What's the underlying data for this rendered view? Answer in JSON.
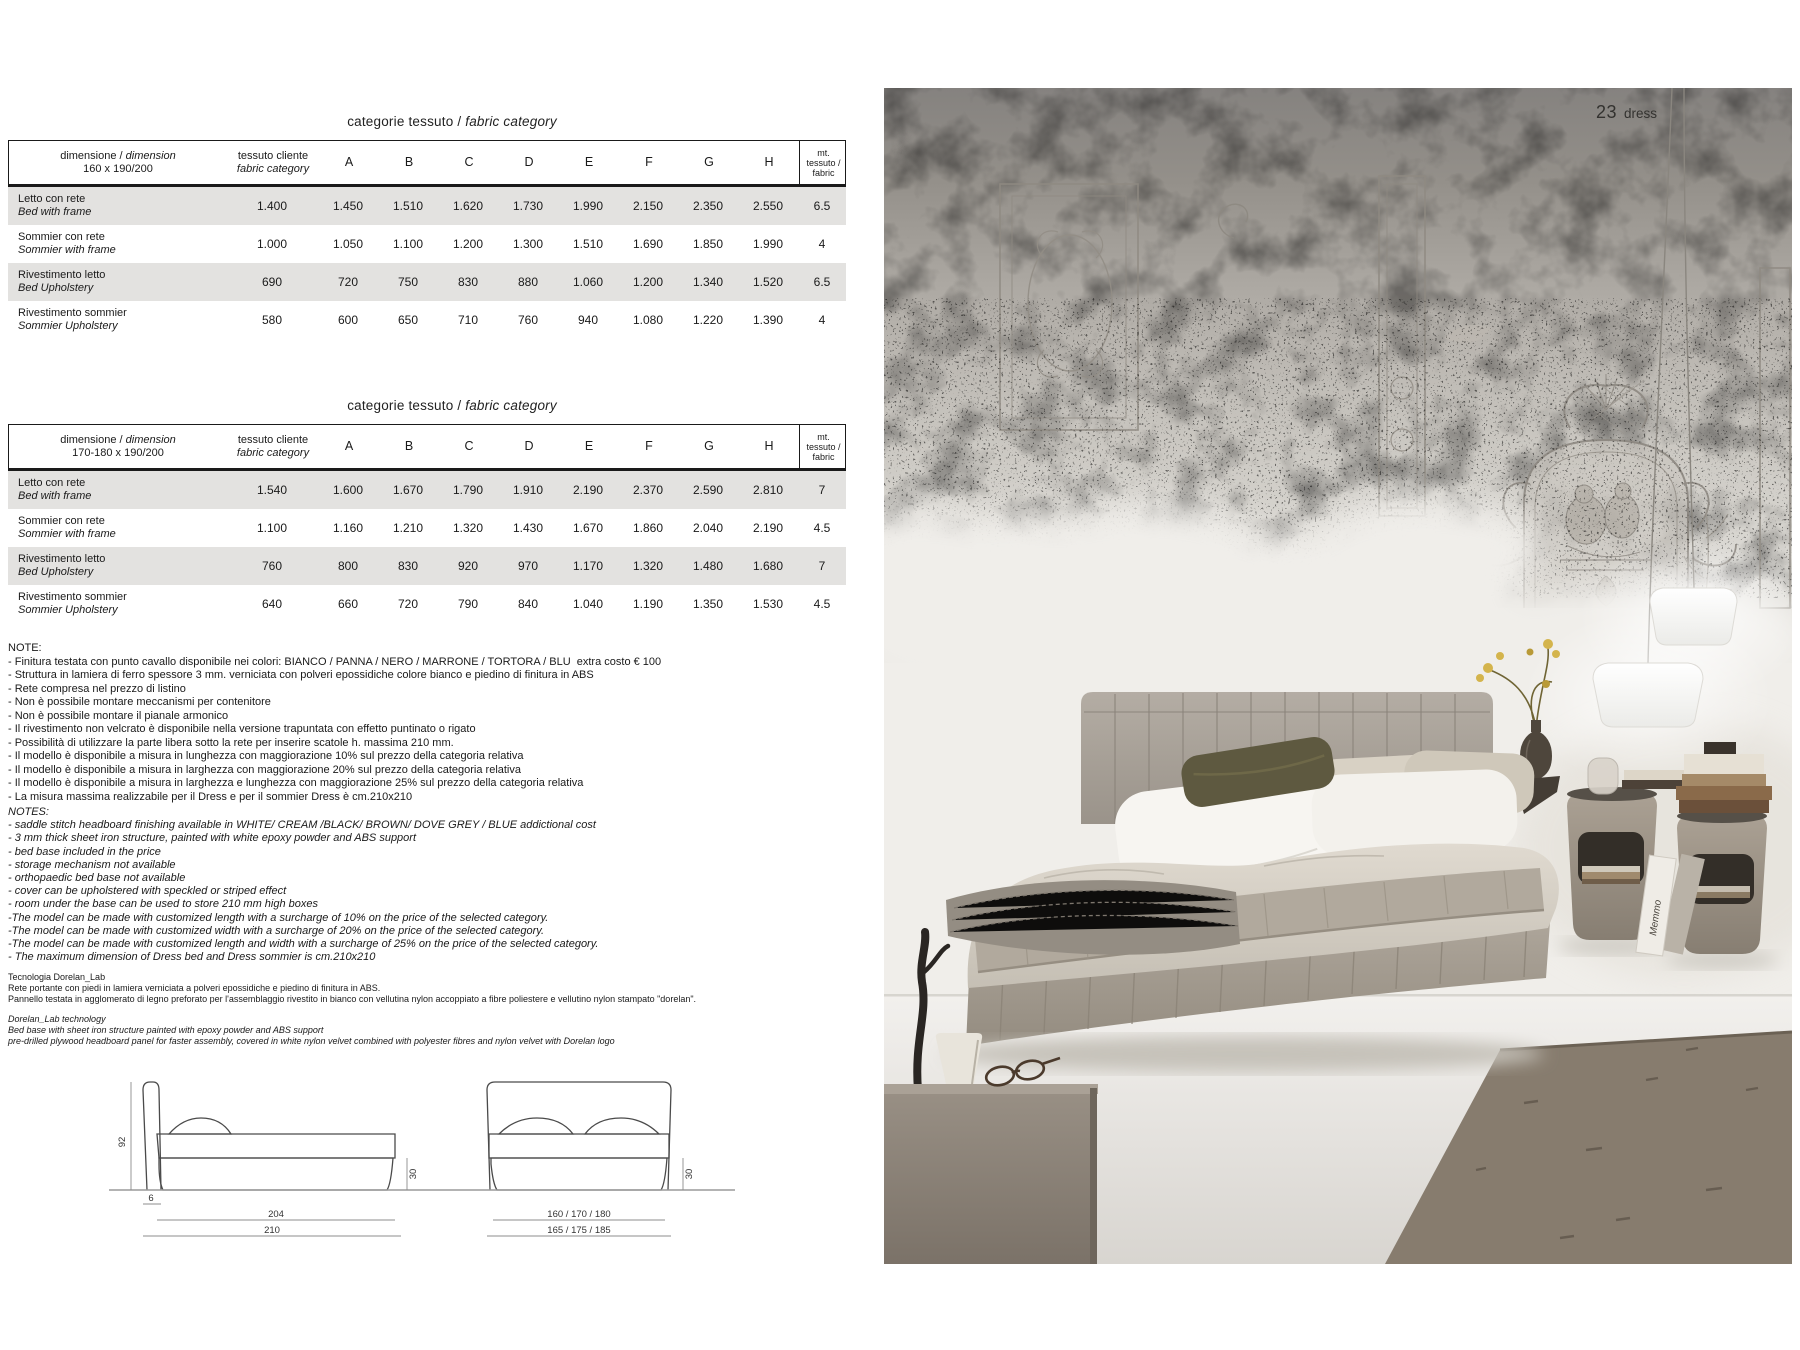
{
  "page_label": {
    "number": "23",
    "name": "dress"
  },
  "table_common": {
    "title_it": "categorie tessuto /",
    "title_en": "fabric category",
    "dimension_prefix_it": "dimensione /",
    "dimension_prefix_en": "dimension",
    "customer_it": "tessuto cliente",
    "customer_en": "fabric category",
    "categories": [
      "A",
      "B",
      "C",
      "D",
      "E",
      "F",
      "G",
      "H"
    ],
    "mt_lines": [
      "mt.",
      "tessuto /",
      "fabric"
    ]
  },
  "tables": [
    {
      "dimension": "160 x 190/200",
      "rows": [
        {
          "it": "Letto con rete",
          "en": "Bed with frame",
          "customer": "1.400",
          "values": [
            "1.450",
            "1.510",
            "1.620",
            "1.730",
            "1.990",
            "2.150",
            "2.350",
            "2.550"
          ],
          "mt": "6.5"
        },
        {
          "it": "Sommier con rete",
          "en": "Sommier with frame",
          "customer": "1.000",
          "values": [
            "1.050",
            "1.100",
            "1.200",
            "1.300",
            "1.510",
            "1.690",
            "1.850",
            "1.990"
          ],
          "mt": "4"
        },
        {
          "it": "Rivestimento letto",
          "en": "Bed Upholstery",
          "customer": "690",
          "values": [
            "720",
            "750",
            "830",
            "880",
            "1.060",
            "1.200",
            "1.340",
            "1.520"
          ],
          "mt": "6.5"
        },
        {
          "it": "Rivestimento sommier",
          "en": "Sommier Upholstery",
          "customer": "580",
          "values": [
            "600",
            "650",
            "710",
            "760",
            "940",
            "1.080",
            "1.220",
            "1.390"
          ],
          "mt": "4"
        }
      ]
    },
    {
      "dimension": "170-180 x 190/200",
      "rows": [
        {
          "it": "Letto con rete",
          "en": "Bed with frame",
          "customer": "1.540",
          "values": [
            "1.600",
            "1.670",
            "1.790",
            "1.910",
            "2.190",
            "2.370",
            "2.590",
            "2.810"
          ],
          "mt": "7"
        },
        {
          "it": "Sommier con rete",
          "en": "Sommier with frame",
          "customer": "1.100",
          "values": [
            "1.160",
            "1.210",
            "1.320",
            "1.430",
            "1.670",
            "1.860",
            "2.040",
            "2.190"
          ],
          "mt": "4.5"
        },
        {
          "it": "Rivestimento letto",
          "en": "Bed Upholstery",
          "customer": "760",
          "values": [
            "800",
            "830",
            "920",
            "970",
            "1.170",
            "1.320",
            "1.480",
            "1.680"
          ],
          "mt": "7"
        },
        {
          "it": "Rivestimento sommier",
          "en": "Sommier Upholstery",
          "customer": "640",
          "values": [
            "660",
            "720",
            "790",
            "840",
            "1.040",
            "1.190",
            "1.350",
            "1.530"
          ],
          "mt": "4.5"
        }
      ]
    }
  ],
  "notes_it": {
    "heading": "NOTE:",
    "items": [
      "- Finitura testata con punto cavallo disponibile nei colori: BIANCO / PANNA / NERO / MARRONE / TORTORA / BLU  extra costo € 100",
      "- Struttura in lamiera di ferro spessore 3 mm. verniciata con polveri epossidiche colore bianco e piedino di finitura in ABS",
      "- Rete compresa nel prezzo di listino",
      "- Non è possibile montare meccanismi per contenitore",
      "- Non è possibile montare il pianale armonico",
      "- Il rivestimento non velcrato è disponibile nella versione trapuntata con effetto puntinato o rigato",
      "- Possibilità di utilizzare la parte libera sotto la rete per inserire scatole h. massima 210 mm.",
      "- Il modello è disponibile a misura in lunghezza con maggiorazione 10% sul prezzo della categoria relativa",
      "- Il modello è disponibile a misura in larghezza con maggiorazione 20% sul prezzo della categoria relativa",
      "- Il modello è disponibile a misura in larghezza e lunghezza con maggiorazione 25% sul prezzo della categoria relativa",
      "- La misura massima realizzabile per il Dress e per il sommier Dress è cm.210x210"
    ]
  },
  "notes_en": {
    "heading": "NOTES:",
    "items": [
      "- saddle stitch headboard finishing available in WHITE/ CREAM /BLACK/ BROWN/ DOVE GREY / BLUE addictional cost",
      "- 3 mm thick sheet iron structure, painted with white epoxy powder and ABS support",
      "- bed base included in the price",
      "- storage mechanism not available",
      "- orthopaedic bed base not available",
      "- cover can be upholstered with speckled or striped effect",
      "- room under the base can be used to store 210 mm high boxes",
      "-The model can be made with customized length with a surcharge of 10% on the price of the selected category.",
      "-The model can be made with customized width with a surcharge of 20% on the price of the selected category.",
      "-The model can be made with customized length and width with a surcharge of 25% on the price of the selected category.",
      "- The maximum dimension of Dress bed and Dress sommier is cm.210x210"
    ]
  },
  "tech_it": {
    "heading": "Tecnologia Dorelan_Lab",
    "lines": [
      "Rete portante con piedi in lamiera verniciata a polveri epossidiche e piedino di finitura in ABS.",
      "Pannello testata in agglomerato di legno preforato per l'assemblaggio rivestito in bianco con vellutina nylon accoppiato a fibre poliestere e vellutino nylon stampato \"dorelan\"."
    ]
  },
  "tech_en": {
    "heading": "Dorelan_Lab technology",
    "lines": [
      "Bed base with sheet iron structure painted with epoxy powder and ABS support",
      "pre-drilled plywood headboard panel for faster assembly, covered in white nylon velvet combined with polyester fibres and nylon velvet with Dorelan logo"
    ]
  },
  "drawings": {
    "side": {
      "height": "92",
      "foot": "6",
      "length_inner": "204",
      "length_outer": "210",
      "base_height": "30"
    },
    "front": {
      "width_inner": "160 / 170 / 180",
      "width_outer": "165 / 175 / 185",
      "base_height": "30"
    }
  },
  "photo": {
    "book_spine": "Memmo"
  },
  "colors": {
    "table_stripe": "#e3e2e0",
    "wall_top": "#878480",
    "plaster": "#cac7c1",
    "white_paint": "#f0eeea",
    "bed_fabric": "#a8a199",
    "duvet": "#d6d0c5",
    "olive_cushion": "#5e5940",
    "stool_taupe": "#a09688",
    "rug": "#877c6e",
    "floor": "#e9e6e2"
  }
}
